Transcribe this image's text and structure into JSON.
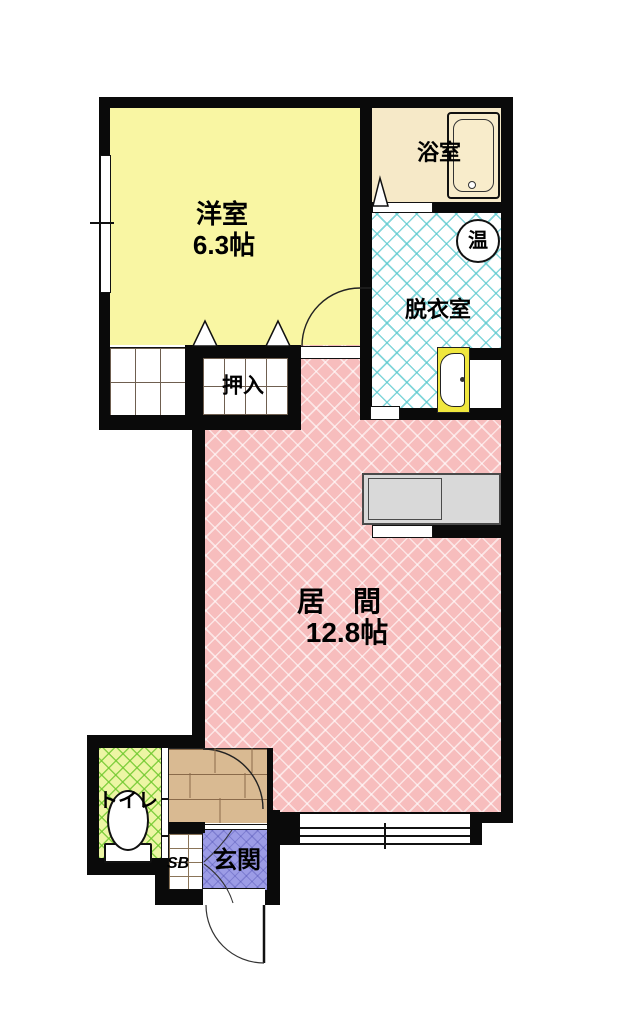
{
  "plan_title": "floor-plan",
  "rooms": {
    "western": {
      "label": "洋室",
      "size": "6.3帖"
    },
    "bath": {
      "label": "浴室"
    },
    "dressing": {
      "label": "脱衣室"
    },
    "water_heater": {
      "label": "温"
    },
    "closet": {
      "label": "押入"
    },
    "living": {
      "label": "居　間",
      "size": "12.8帖"
    },
    "toilet": {
      "label": "トイレ"
    },
    "shoe_box": {
      "label": "SB"
    },
    "entrance": {
      "label": "玄関"
    }
  },
  "colors": {
    "western_room": "#F9F6A3",
    "bath_room": "#F6E9C8",
    "dressing_hatch": "#58C8CD",
    "living_room": "#F7BDBD",
    "toilet_room": "#EDF5A4",
    "toilet_hatch": "#6EC82D",
    "entrance_room": "#9C9CE6",
    "wood_floor": "#D9BA92",
    "kitchen_counter": "#D9D9D9",
    "wash_basin": "#F0E73E",
    "wall": "#0A0A0A"
  }
}
